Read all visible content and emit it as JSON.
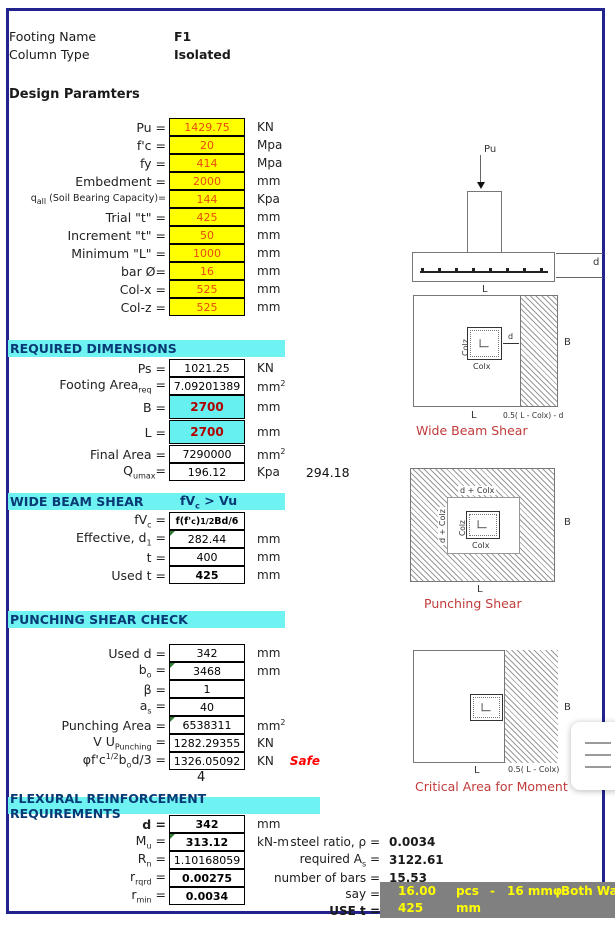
{
  "colors": {
    "navy_border": "#23238E",
    "yellow_cell": "#FFFF00",
    "cyan_band": "#6EF2F2",
    "cyan_cell": "#66F0F0",
    "input_value": "#E8490B",
    "bl_value": "#B00000",
    "safe_red": "#FF0000",
    "caption_red": "#C23B3B",
    "banner_bg": "#808080",
    "banner_text": "#FFFF00"
  },
  "header": {
    "footing_name_label": "Footing Name",
    "footing_name_value": "F1",
    "column_type_label": "Column Type",
    "column_type_value": "Isolated",
    "design_title": "Design Paramters"
  },
  "params": {
    "rows": [
      {
        "pre": "Pu =",
        "value": "1429.75",
        "unit": "KN"
      },
      {
        "pre": "f'c =",
        "value": "20",
        "unit": "Mpa"
      },
      {
        "pre": "fy =",
        "value": "414",
        "unit": "Mpa"
      },
      {
        "pre": "Embedment =",
        "value": "2000",
        "unit": "mm"
      },
      {
        "pre": "q",
        "sub": "all",
        "post": " (Soil Bearing Capacity)=",
        "value": "144",
        "unit": "Kpa"
      },
      {
        "pre": "Trial \"t\" =",
        "value": "425",
        "unit": "mm"
      },
      {
        "pre": "Increment \"t\" =",
        "value": "50",
        "unit": "mm"
      },
      {
        "pre": "Minimum \"L\" =",
        "value": "1000",
        "unit": "mm"
      },
      {
        "pre": "bar Ø=",
        "value": "16",
        "unit": "mm"
      },
      {
        "pre": "Col-x =",
        "value": "525",
        "unit": "mm"
      },
      {
        "pre": "Col-z =",
        "value": "525",
        "unit": "mm"
      }
    ]
  },
  "required": {
    "title": "REQUIRED DIMENSIONS",
    "rows": [
      {
        "pre": "Ps =",
        "value": "1021.25",
        "unit": "KN"
      },
      {
        "pre": "Footing Area",
        "sub": "req",
        "post": " =",
        "value": "7.09201389",
        "unit": "mm",
        "unit_sup": "2"
      },
      {
        "pre": "B =",
        "value": "2700",
        "unit": "mm"
      },
      {
        "pre": "L =",
        "value": "2700",
        "unit": "mm"
      },
      {
        "pre": "Final Area =",
        "value": "7290000",
        "unit": "mm",
        "unit_sup": "2"
      },
      {
        "pre": "Q",
        "sub": "umax",
        "post": "=",
        "value": "196.12",
        "unit": "Kpa",
        "extra": "294.18"
      }
    ]
  },
  "wide_beam": {
    "title": "WIDE BEAM SHEAR",
    "cond": {
      "pre": "fV",
      "sub": "c",
      "post": " > Vu"
    },
    "formula_row": {
      "pre": "fV",
      "sub": "c",
      "post": " ="
    },
    "formula": {
      "f1": "f(f'",
      "f1sub": "c",
      "f2": ")",
      "f2sup": "1/2",
      "f3": "Bd/6"
    },
    "rows": [
      {
        "pre": "Effective, d",
        "sub": "1",
        "post": " =",
        "value": "282.44",
        "unit": "mm"
      },
      {
        "pre": "t =",
        "value": "400",
        "unit": "mm"
      },
      {
        "pre": "Used t =",
        "value": "425",
        "unit": "mm"
      }
    ]
  },
  "punching": {
    "title": "PUNCHING SHEAR CHECK",
    "stray": "4",
    "rows": [
      {
        "pre": "Used d =",
        "value": "342",
        "unit": "mm"
      },
      {
        "pre": "b",
        "sub": "o",
        "post": " =",
        "value": "3468",
        "unit": "mm"
      },
      {
        "pre": "β =",
        "value": "1",
        "unit": ""
      },
      {
        "pre": "a",
        "sub": "s",
        "post": " =",
        "value": "40",
        "unit": ""
      },
      {
        "pre": "Punching Area =",
        "value": "6538311",
        "unit": "mm",
        "unit_sup": "2"
      },
      {
        "pre": "V U",
        "sub": "Punching",
        "post": " =",
        "value": "1282.29355",
        "unit": "KN"
      },
      {
        "l1": "φf'c",
        "l1sup": "1/2",
        "l2": "b",
        "l2sub": "o",
        "l3": "d/3 =",
        "value": "1326.05092",
        "unit": "KN",
        "status": "Safe"
      }
    ]
  },
  "flexural": {
    "title": "FLEXURAL REINFORCEMENT REQUIREMENTS",
    "rows": [
      {
        "pre": "d =",
        "value": "342",
        "unit": "mm"
      },
      {
        "pre": "M",
        "sub": "u",
        "post": " =",
        "value": "313.12",
        "unit": "kN-m"
      },
      {
        "pre": "R",
        "sub": "n",
        "post": " =",
        "value": "1.10168059",
        "unit": ""
      },
      {
        "pre": "r",
        "sub": "rqrd",
        "post": " =",
        "value": "0.00275",
        "unit": ""
      },
      {
        "pre": "r",
        "sub": "min",
        "post": " =",
        "value": "0.0034",
        "unit": ""
      }
    ],
    "right": {
      "steel": {
        "pre": "steel ratio, ρ =",
        "value": "0.0034"
      },
      "areq": {
        "pre": "required A",
        "sub": "s",
        "post": " =",
        "value": "3122.61"
      },
      "bars": {
        "pre": "number of bars =",
        "value": "15.53"
      },
      "say": {
        "label": "say =",
        "value": "16.00",
        "pcs": "pcs",
        "dash": "-",
        "size": "16 mmφ",
        "way": "Both Way"
      },
      "use": {
        "label": "USE t =",
        "value": "425",
        "unit": "mm"
      }
    }
  },
  "diagrams": {
    "elevation": {
      "load": "Pu",
      "l": "L",
      "d": "d"
    },
    "wide_beam": {
      "caption": "Wide Beam Shear",
      "colz": "Colz",
      "colx": "Colx",
      "d": "d",
      "b": "B",
      "l": "L",
      "strip": "0.5( L - Colx) - d"
    },
    "punching": {
      "caption": "Punching Shear",
      "top": "d + Colx",
      "left": "d + Colz",
      "colz": "Colz",
      "colx": "Colx",
      "b": "B",
      "l": "L"
    },
    "moment": {
      "caption": "Critical Area for Moment",
      "b": "B",
      "l": "L",
      "strip": "0.5( L - Colx)"
    }
  },
  "menu_button": {
    "icon": "hamburger-menu-icon"
  }
}
